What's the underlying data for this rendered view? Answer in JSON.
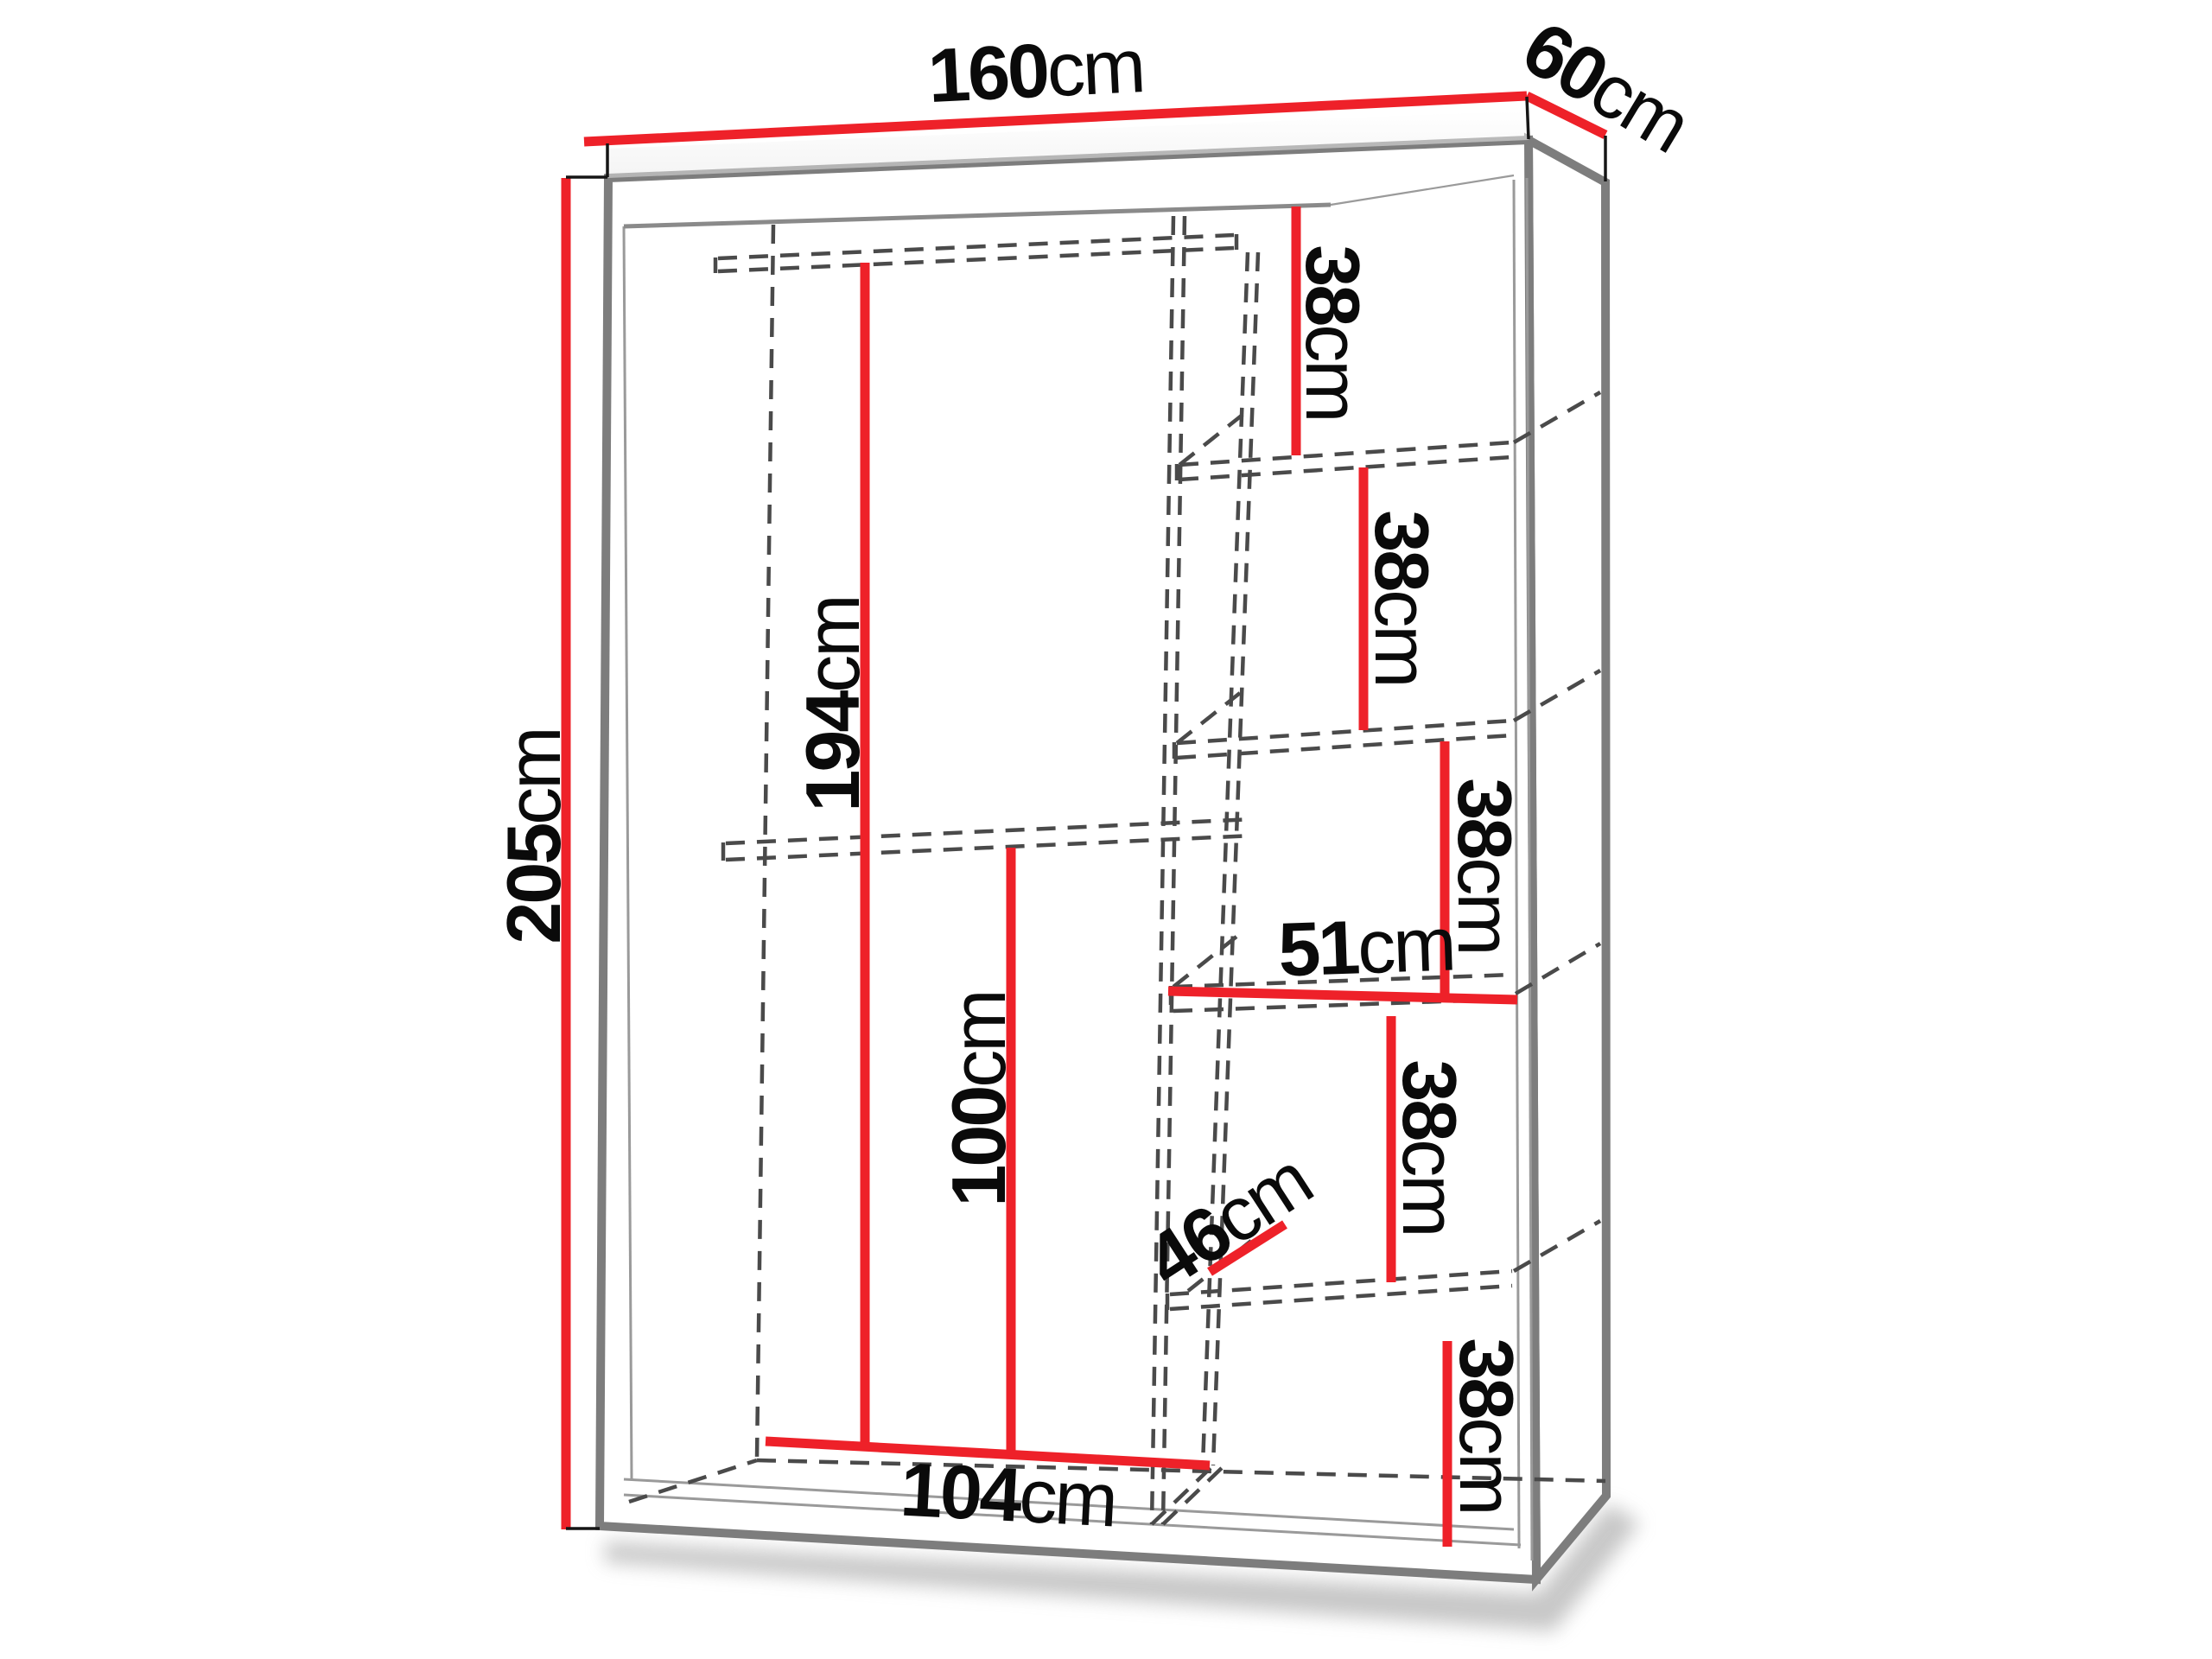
{
  "page": {
    "title": "Wardrobe dimension diagram",
    "description": "Perspective line drawing of a sliding-door wardrobe with red dimension lines, dashed hidden interior edges (clothes rail, partition, shelves) and measurement labels"
  },
  "colors": {
    "c-red": "#ee2129",
    "c-outline": "#7d7d7d",
    "c-inner": "#9a9a9a",
    "c-hidden": "#4a4a4a",
    "c-text": "#0a0a0a",
    "c-bg": "#ffffff"
  },
  "dimensions": {
    "width": {
      "value": "160",
      "unit": "cm"
    },
    "depth": {
      "value": "60",
      "unit": "cm"
    },
    "height": {
      "value": "205",
      "unit": "cm"
    },
    "interior_height": {
      "value": "194",
      "unit": "cm"
    },
    "lower_section_height": {
      "value": "100",
      "unit": "cm"
    },
    "left_compartment_width": {
      "value": "104",
      "unit": "cm"
    },
    "shelf_column_width": {
      "value": "51",
      "unit": "cm"
    },
    "shelf_depth": {
      "value": "46",
      "unit": "cm"
    },
    "shelf_gaps": [
      {
        "value": "38",
        "unit": "cm"
      },
      {
        "value": "38",
        "unit": "cm"
      },
      {
        "value": "38",
        "unit": "cm"
      },
      {
        "value": "38",
        "unit": "cm"
      },
      {
        "value": "38",
        "unit": "cm"
      }
    ]
  }
}
